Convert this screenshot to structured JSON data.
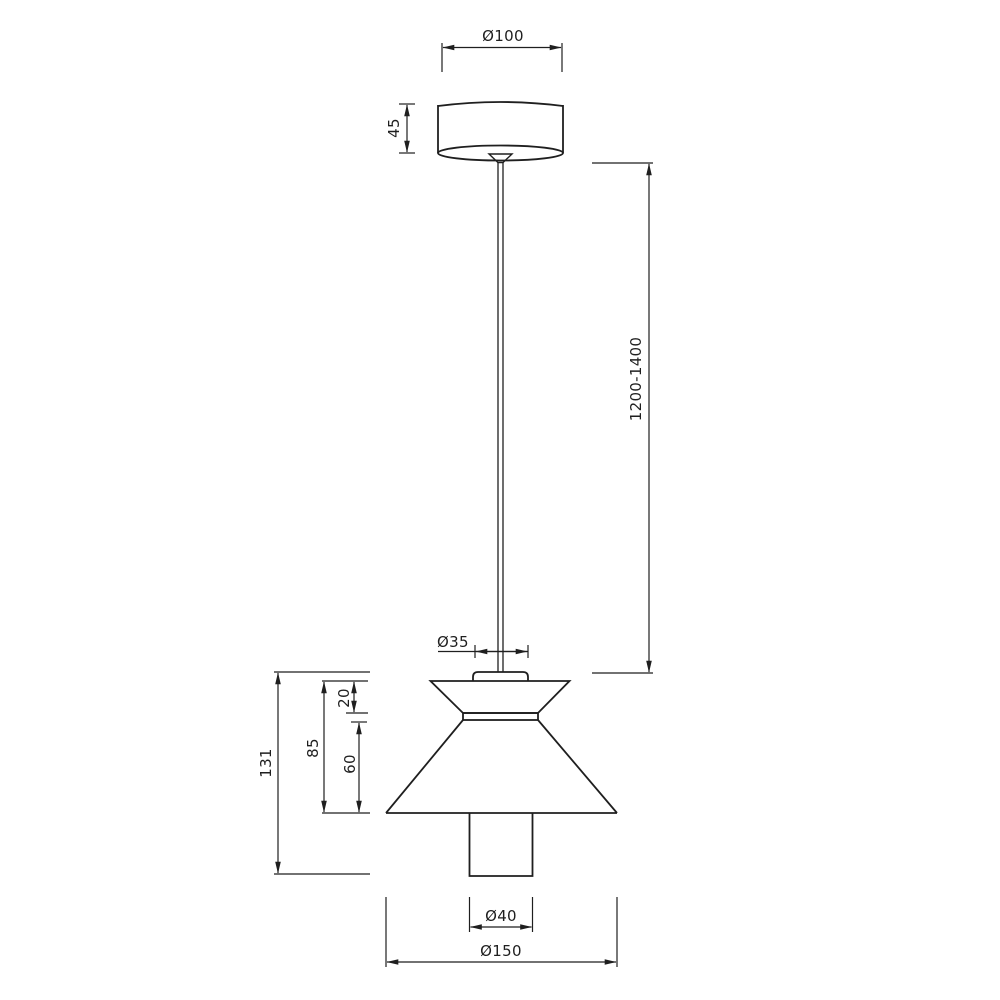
{
  "drawing": {
    "type": "pendant-lamp-dimension-drawing",
    "colors": {
      "line": "#1f1f1f",
      "background": "#ffffff"
    },
    "labels": {
      "canopy_diameter": "Ø100",
      "canopy_height": "45",
      "suspension_length": "1200-1400",
      "connector_diameter": "Ø35",
      "overall_body_height": "131",
      "shade_height": "85",
      "upper_cone_height": "20",
      "lower_cone_height": "60",
      "cylinder_diameter": "Ø40",
      "shade_diameter": "Ø150"
    }
  }
}
